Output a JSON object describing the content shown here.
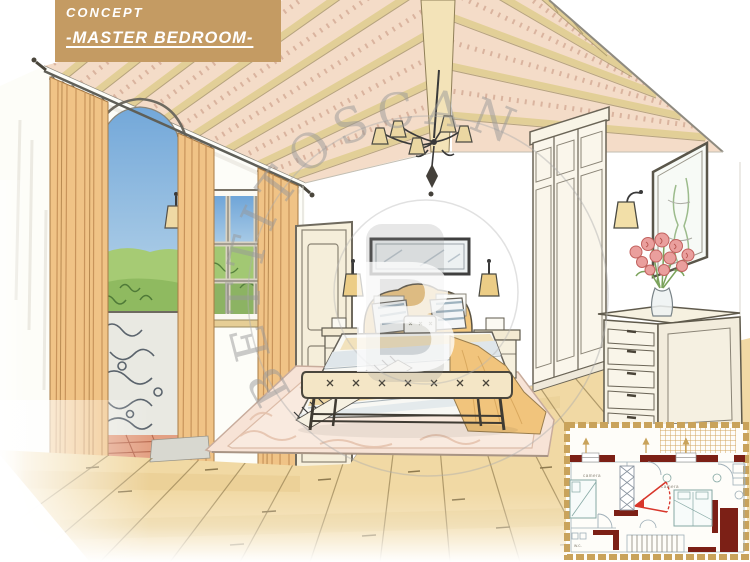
{
  "header": {
    "kicker": "CONCEPT",
    "title": "-MASTER BEDROOM-",
    "bg_color": "#C49B63",
    "text_color": "#FFFFFF"
  },
  "watermark": {
    "arc_text": "BETTITOSCANA",
    "monogram": "B",
    "color": "#999999"
  },
  "floor_plan": {
    "labels": {
      "room_left": "camera",
      "room_right": "camera",
      "wc": "w.c."
    },
    "colors": {
      "wall": "#7C2016",
      "line": "#9FAFB8",
      "view_cone": "#D8362B",
      "border": "#C9A35B"
    }
  },
  "palette": {
    "curtain": "#F0C386",
    "beam": "#E2CF97",
    "brick": "#F4DCC8",
    "ridge": "#F3E3B8",
    "sky": "#74A9DA",
    "grass": "#9CC46E",
    "wood_floor": "#F1D9A4",
    "rug": "#F7E3D6",
    "bed_gold": "#F1C47C",
    "bench": "#F4E6C6",
    "terracotta": "#E3A083",
    "rose": "#EA9F9D"
  }
}
